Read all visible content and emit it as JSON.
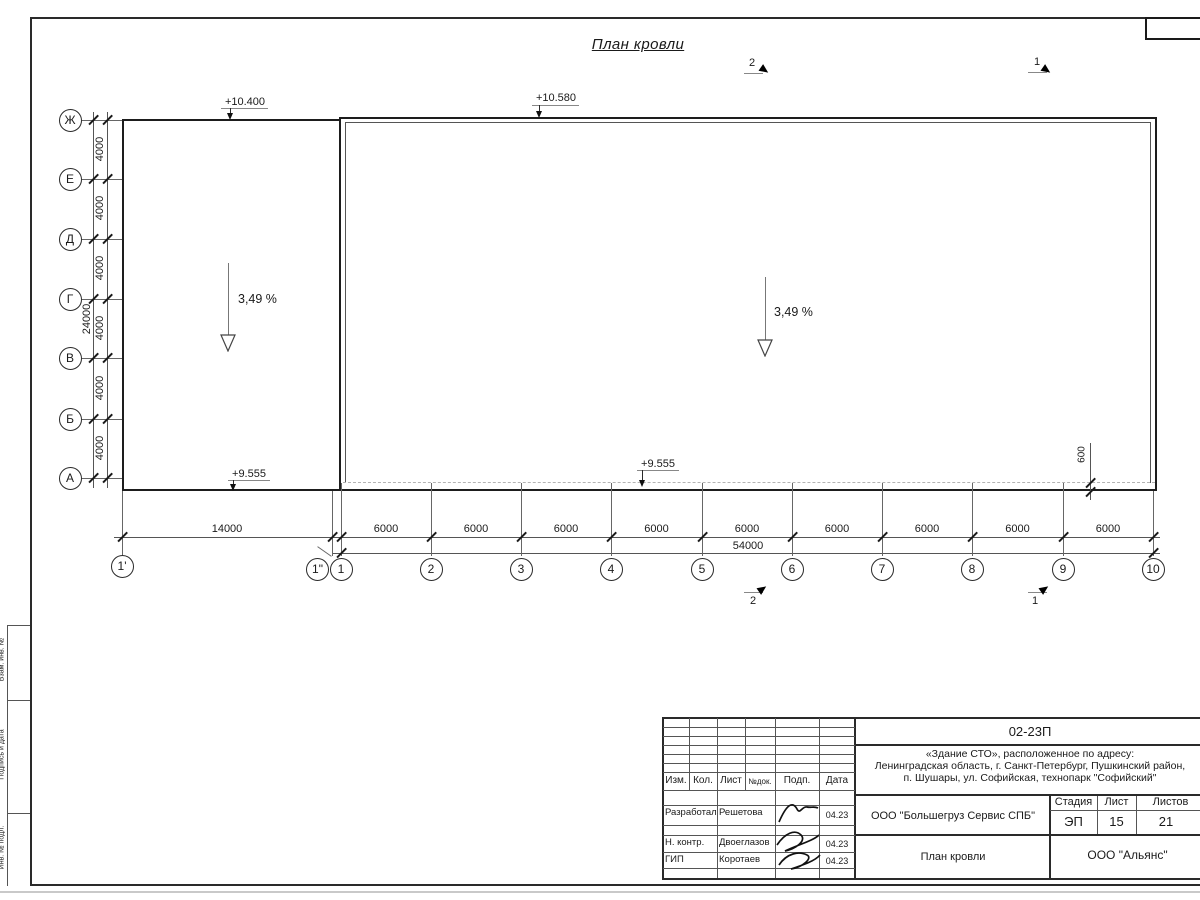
{
  "drawing": {
    "title": "План кровли",
    "elevations": {
      "top_left": "+10.400",
      "top_right": "+10.580",
      "bottom_left": "+9.555",
      "bottom_center": "+9.555"
    },
    "slope_left": "3,49 %",
    "slope_right": "3,49 %",
    "sections": {
      "top_left": "2",
      "top_right": "1",
      "bottom_left": "2",
      "bottom_right": "1"
    },
    "axes_left": [
      "Ж",
      "Е",
      "Д",
      "Г",
      "В",
      "Б",
      "А"
    ],
    "axes_bottom": [
      "1'",
      "1\"",
      "1",
      "2",
      "3",
      "4",
      "5",
      "6",
      "7",
      "8",
      "9",
      "10"
    ],
    "dim_v_segment": "4000",
    "dim_v_total": "24000",
    "dim_h_first": "14000",
    "dim_h_segment": "6000",
    "dim_h_total": "54000",
    "dim_offset": "600"
  },
  "margin": {
    "labels": [
      "Взам. инв. №",
      "Подпись и дата",
      "Инв. № подл."
    ]
  },
  "title_block": {
    "doc_number": "02-23П",
    "project_line1": "«Здание СТО», расположенное по адресу:",
    "project_line2": "Ленинградская область, г. Санкт-Петербург, Пушкинский район,",
    "project_line3": "п. Шушары, ул. Софийская, технопарк \"Софийский\"",
    "client": "ООО \"Большегруз Сервис СПБ\"",
    "sheet_title": "План кровли",
    "company": "ООО \"Альянс\"",
    "stage_label": "Стадия",
    "sheet_label": "Лист",
    "sheets_label": "Листов",
    "stage": "ЭП",
    "sheet_no": "15",
    "sheets_total": "21",
    "col_izm": "Изм.",
    "col_kol": "Кол.",
    "col_list": "Лист",
    "col_doc": "№док.",
    "col_podp": "Подп.",
    "col_data": "Дата",
    "rows": [
      {
        "role": "Разработал",
        "name": "Решетова",
        "date": "04.23"
      },
      {
        "role": "Н. контр.",
        "name": "Двоеглазов",
        "date": "04.23"
      },
      {
        "role": "ГИП",
        "name": "Коротаев",
        "date": "04.23"
      }
    ]
  }
}
